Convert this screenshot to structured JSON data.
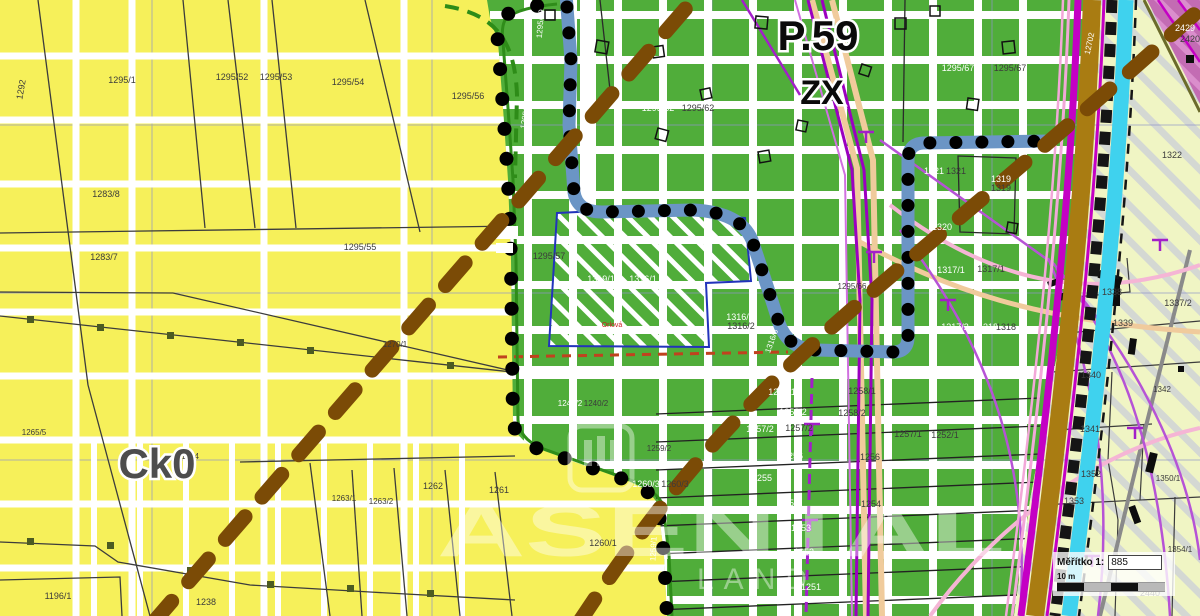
{
  "map": {
    "region_labels": {
      "p59": "P.59",
      "zx": "ZX",
      "ck0": "Ck0"
    },
    "watermark": {
      "line1": "ASENTAL",
      "line2": "LAND"
    },
    "scale": {
      "label": "Měřítko  1:",
      "value": "885",
      "bar_label": "10 m"
    },
    "colors": {
      "yellow_zone": "#f6f05a",
      "green_zone": "#50ad3a",
      "pale_zone": "#f0f5c4",
      "pink_zone": "#c36cb3",
      "blue_boundary_band": "#6b95c5",
      "change_area_outline": "#2233bb",
      "brown_dashed_line": "#7b4b06",
      "cyan_band": "#3fd2ee",
      "ochre_band": "#a97c12",
      "magenta_utility": "#c400c4",
      "red_dashed": "#c0421e"
    },
    "parcel_labels": [
      {
        "t": "1292",
        "x": 24,
        "y": 90,
        "c": "dark",
        "r": -80
      },
      {
        "t": "1295/1",
        "x": 122,
        "y": 83,
        "c": "dark"
      },
      {
        "t": "1295/52",
        "x": 232,
        "y": 80,
        "c": "dark"
      },
      {
        "t": "1295/53",
        "x": 276,
        "y": 80,
        "c": "dark"
      },
      {
        "t": "1295/54",
        "x": 348,
        "y": 85,
        "c": "dark"
      },
      {
        "t": "1295/56",
        "x": 468,
        "y": 99,
        "c": "dark"
      },
      {
        "t": "1283/8",
        "x": 106,
        "y": 197,
        "c": "dark"
      },
      {
        "t": "1283/7",
        "x": 104,
        "y": 260,
        "c": "dark"
      },
      {
        "t": "1295/55",
        "x": 360,
        "y": 250,
        "c": "dark"
      },
      {
        "t": "1270/1",
        "x": 395,
        "y": 347,
        "c": "dark",
        "fs": 8
      },
      {
        "t": "1265/5",
        "x": 34,
        "y": 435,
        "c": "dark",
        "fs": 8
      },
      {
        "t": "1264",
        "x": 190,
        "y": 459,
        "c": "dark",
        "fs": 8
      },
      {
        "t": "1196/1",
        "x": 58,
        "y": 599,
        "c": "dark"
      },
      {
        "t": "1238",
        "x": 206,
        "y": 605,
        "c": "dark"
      },
      {
        "t": "1263/1",
        "x": 344,
        "y": 501,
        "c": "dark",
        "fs": 8
      },
      {
        "t": "1263/2",
        "x": 381,
        "y": 504,
        "c": "dark",
        "fs": 8
      },
      {
        "t": "1262",
        "x": 433,
        "y": 489,
        "c": "dark"
      },
      {
        "t": "1261",
        "x": 499,
        "y": 493,
        "c": "dark"
      },
      {
        "t": "1260/1",
        "x": 603,
        "y": 546,
        "c": "dark"
      },
      {
        "t": "1295/67",
        "x": 958,
        "y": 71,
        "c": "white"
      },
      {
        "t": "1295/67",
        "x": 1010,
        "y": 71,
        "c": "dark"
      },
      {
        "t": "1295/62",
        "x": 658,
        "y": 111,
        "c": "white"
      },
      {
        "t": "1295/62",
        "x": 698,
        "y": 111,
        "c": "dark"
      },
      {
        "t": "1295/59",
        "x": 543,
        "y": 24,
        "c": "white",
        "r": -85,
        "fs": 8
      },
      {
        "t": "1295/58",
        "x": 528,
        "y": 115,
        "c": "white",
        "r": -80,
        "fs": 8
      },
      {
        "t": "1295/57",
        "x": 549,
        "y": 259,
        "c": "dark"
      },
      {
        "t": "1295/5",
        "x": 531,
        "y": 307,
        "c": "white",
        "r": -85,
        "fs": 8
      },
      {
        "t": "1319/1",
        "x": 601,
        "y": 282,
        "c": "white"
      },
      {
        "t": "1316/1",
        "x": 643,
        "y": 282,
        "c": "white"
      },
      {
        "t": "1316/2",
        "x": 740,
        "y": 320,
        "c": "white"
      },
      {
        "t": "1316/2",
        "x": 741,
        "y": 329,
        "c": "dark"
      },
      {
        "t": "1316/3",
        "x": 774,
        "y": 342,
        "c": "white",
        "r": -70,
        "fs": 8
      },
      {
        "t": "1295/66",
        "x": 852,
        "y": 289,
        "c": "dark",
        "fs": 8
      },
      {
        "t": "1321",
        "x": 934,
        "y": 174,
        "c": "white"
      },
      {
        "t": "1321",
        "x": 956,
        "y": 174,
        "c": "dark"
      },
      {
        "t": "1319",
        "x": 1001,
        "y": 182,
        "c": "white"
      },
      {
        "t": "1319",
        "x": 1001,
        "y": 191,
        "c": "dark"
      },
      {
        "t": "1320",
        "x": 942,
        "y": 230,
        "c": "white"
      },
      {
        "t": "1317/1",
        "x": 951,
        "y": 273,
        "c": "white"
      },
      {
        "t": "1317/1",
        "x": 991,
        "y": 272,
        "c": "dark"
      },
      {
        "t": "1317/2",
        "x": 955,
        "y": 330,
        "c": "white"
      },
      {
        "t": "1318",
        "x": 988,
        "y": 330,
        "c": "white"
      },
      {
        "t": "1318",
        "x": 1006,
        "y": 330,
        "c": "dark"
      },
      {
        "t": "1240/2",
        "x": 570,
        "y": 406,
        "c": "white",
        "fs": 8
      },
      {
        "t": "1240/2",
        "x": 596,
        "y": 406,
        "c": "dark",
        "fs": 8
      },
      {
        "t": "1260/3",
        "x": 646,
        "y": 487,
        "c": "white"
      },
      {
        "t": "1260/3",
        "x": 675,
        "y": 487,
        "c": "dark"
      },
      {
        "t": "1259/2",
        "x": 659,
        "y": 451,
        "c": "dark",
        "fs": 8
      },
      {
        "t": "1259/1",
        "x": 656,
        "y": 549,
        "c": "white",
        "r": -87,
        "fs": 8
      },
      {
        "t": "1258/1",
        "x": 782,
        "y": 395,
        "c": "white"
      },
      {
        "t": "1258/1",
        "x": 862,
        "y": 394,
        "c": "dark"
      },
      {
        "t": "1258/2",
        "x": 793,
        "y": 415,
        "c": "white"
      },
      {
        "t": "1258/2",
        "x": 852,
        "y": 416,
        "c": "dark"
      },
      {
        "t": "1257/2",
        "x": 760,
        "y": 432,
        "c": "white"
      },
      {
        "t": "1257/2",
        "x": 799,
        "y": 431,
        "c": "dark"
      },
      {
        "t": "1257/1",
        "x": 908,
        "y": 437,
        "c": "dark"
      },
      {
        "t": "1252/1",
        "x": 945,
        "y": 438,
        "c": "dark"
      },
      {
        "t": "1256",
        "x": 793,
        "y": 459,
        "c": "white"
      },
      {
        "t": "1256",
        "x": 870,
        "y": 460,
        "c": "dark"
      },
      {
        "t": "1255",
        "x": 762,
        "y": 481,
        "c": "white"
      },
      {
        "t": "1254",
        "x": 789,
        "y": 506,
        "c": "white"
      },
      {
        "t": "1254",
        "x": 871,
        "y": 507,
        "c": "dark"
      },
      {
        "t": "1253",
        "x": 801,
        "y": 531,
        "c": "white"
      },
      {
        "t": "1252",
        "x": 804,
        "y": 555,
        "c": "white"
      },
      {
        "t": "1251",
        "x": 811,
        "y": 590,
        "c": "white"
      },
      {
        "t": "12702",
        "x": 1092,
        "y": 44,
        "c": "white",
        "r": -78,
        "fs": 8
      },
      {
        "t": "2429",
        "x": 1185,
        "y": 31,
        "c": "white"
      },
      {
        "t": "2420",
        "x": 1190,
        "y": 42,
        "c": "dark"
      },
      {
        "t": "1322",
        "x": 1172,
        "y": 158,
        "c": "dark"
      },
      {
        "t": "1338",
        "x": 1112,
        "y": 295,
        "c": "dark"
      },
      {
        "t": "1337/2",
        "x": 1178,
        "y": 306,
        "c": "dark"
      },
      {
        "t": "1339",
        "x": 1123,
        "y": 326,
        "c": "dark"
      },
      {
        "t": "1340",
        "x": 1091,
        "y": 378,
        "c": "dark"
      },
      {
        "t": "1342",
        "x": 1162,
        "y": 392,
        "c": "dark",
        "fs": 8
      },
      {
        "t": "1341",
        "x": 1090,
        "y": 432,
        "c": "dark"
      },
      {
        "t": "1352",
        "x": 1091,
        "y": 477,
        "c": "dark"
      },
      {
        "t": "1353",
        "x": 1074,
        "y": 504,
        "c": "dark"
      },
      {
        "t": "1350/1",
        "x": 1168,
        "y": 481,
        "c": "dark",
        "fs": 8
      },
      {
        "t": "1354/1",
        "x": 1180,
        "y": 552,
        "c": "dark",
        "fs": 8
      },
      {
        "t": "2440",
        "x": 1150,
        "y": 596,
        "c": "dark"
      },
      {
        "t": "Orlová",
        "x": 612,
        "y": 327,
        "c": "red",
        "fs": 7
      }
    ]
  }
}
